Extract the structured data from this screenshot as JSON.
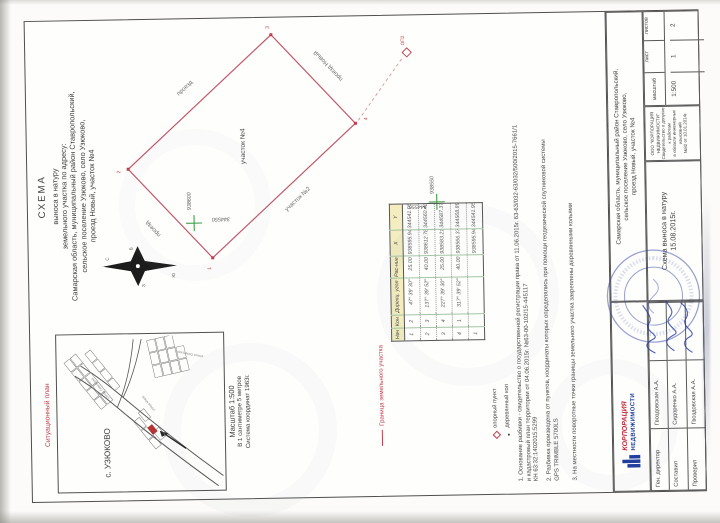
{
  "document": {
    "title_lines": [
      "СХЕМА",
      "выноса в натуру",
      "земельного участка по адресу:",
      "Самарская область, муниципальный район Ставропольский,",
      "сельское поселение Узюково, село Узюково,",
      "проезд Новый, участок №4"
    ]
  },
  "situational_plan": {
    "caption": "Ситуационный план",
    "settlement": "с. УЗЮКОВО",
    "street_labels": [
      "улица Советская",
      "улица Мира"
    ],
    "scale_lines": [
      "Масштаб 1:500",
      "В 1 сантиметре 5 метров",
      "Система координат 1963г."
    ]
  },
  "compass": {
    "n": "С",
    "s": "Ю",
    "e": "В",
    "w": "З"
  },
  "diagram": {
    "parcel_label": "участок №4",
    "edge_labels": {
      "nw": "проезд",
      "ne": "проезд",
      "se": "проезд Новый",
      "sw": "участок №2"
    },
    "vertex_numbers": [
      "1",
      "2",
      "3",
      "4"
    ],
    "grid_crosses": [
      {
        "x_label": "938600",
        "y_label": "344550"
      },
      {
        "x_label": "938550",
        "y_label": "344550"
      }
    ],
    "control_point": {
      "label": "ОП2"
    },
    "colors": {
      "parcel_outline": "#c2576a",
      "grid_cross": "#3f9e44",
      "control_point": "#c23a4b"
    }
  },
  "legend": {
    "boundary": "Граница земельного участка",
    "control_point": "опорный пункт",
    "wooden_stake": "деревянный кол"
  },
  "coordinates_table": {
    "headers": [
      "Нач",
      "Кон",
      "Дирекц. угол",
      "Рас-ние",
      "X",
      "Y"
    ],
    "rows": [
      [
        "1",
        "2",
        "47° 39′ 30″",
        "25.00",
        "938595.94",
        "344541.95"
      ],
      [
        "2",
        "3",
        "137° 39′ 52″",
        "40.00",
        "938612.78",
        "344560.43"
      ],
      [
        "3",
        "4",
        "227° 39′ 30″",
        "25.00",
        "938583.21",
        "344587.37"
      ],
      [
        "4",
        "1",
        "317° 39′ 52″",
        "40.00",
        "938566.37",
        "344568.89"
      ],
      [
        "1",
        "",
        "",
        "",
        "938595.94",
        "344541.95"
      ]
    ]
  },
  "notes": [
    {
      "lines": [
        "1. Основание разбивки - свидетельство о государственной регистрации права от 11.06.2015г. 63-63/032-63/032/500/2015-7661/1",
        "и кадастровый план территории от 04.06.2015г. №63-00-102/15-445117",
        "КН 63:32:1402015:5299"
      ]
    },
    {
      "lines": [
        "2. Разбивка произведена от пунктов, координаты которых определялись при помощи геодезической спутниковой системы",
        "GPS TRIMBLE 5700LS"
      ]
    },
    {
      "lines": [
        "3. На местности поворотные точки границы земельного участка закреплены деревянными кольями"
      ]
    }
  ],
  "stamp": {
    "address_lines": [
      "Самарская область, муниципальный район Ставропольский,",
      "сельское поселение Узюково, село Узюково,",
      "проезд Новый, участок №4"
    ],
    "doc_type": "Схема выноса в натуру",
    "date": "15.08.2015г.",
    "scale": {
      "label": "масштаб",
      "value": "1:500"
    },
    "sheet": {
      "label": "лист",
      "value": "1"
    },
    "sheets_total": {
      "label": "листов",
      "value": "2"
    },
    "org_lines": [
      "ООО \"КОРПОРАЦИЯ НЕДВИЖИМОСТИ\"",
      "Свидетельство о допуске к работам",
      "в области инженерных изысканий",
      "№82 от 10.01.2014г."
    ],
    "logo": {
      "line1": "КОРПОРАЦИЯ",
      "line2": "НЕДВИЖИМОСТИ"
    },
    "signatures": [
      {
        "role": "Ген. директор",
        "name": "Гвоздовская А.А."
      },
      {
        "role": "Составил",
        "name": "Сидоренко А.А."
      },
      {
        "role": "Проверил",
        "name": "Гвоздовская А.А."
      }
    ]
  }
}
